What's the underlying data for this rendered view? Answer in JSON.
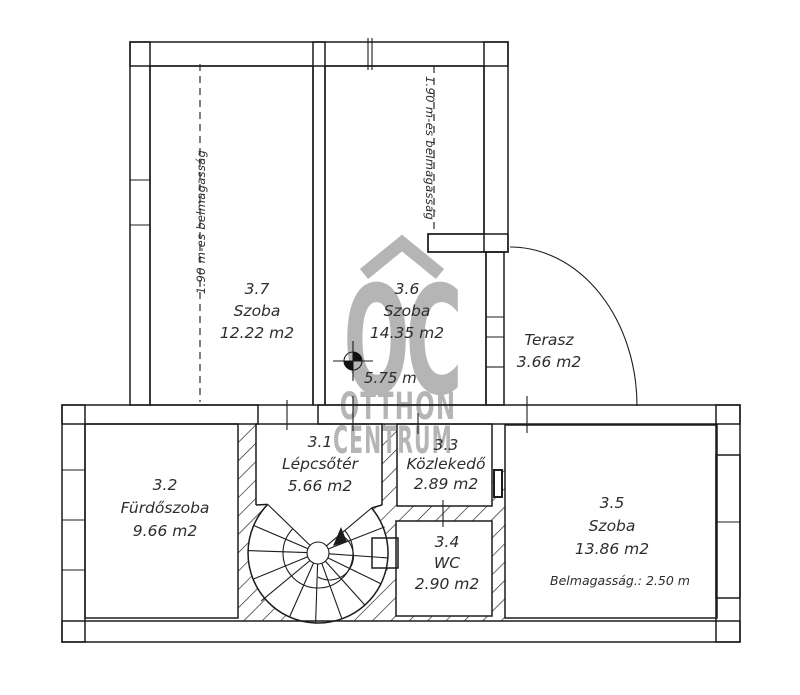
{
  "plan": {
    "rooms": {
      "r37": {
        "id": "3.7",
        "name": "Szoba",
        "area": "12.22 m2",
        "height_note": "1.90 m-es belmagasság"
      },
      "r36": {
        "id": "3.6",
        "name": "Szoba",
        "area": "14.35 m2",
        "height_note": "1.90 m-es belmagasság"
      },
      "terasz": {
        "name": "Terasz",
        "area": "3.66 m2"
      },
      "r31": {
        "id": "3.1",
        "name": "Lépcsőtér",
        "area": "5.66 m2"
      },
      "r32": {
        "id": "3.2",
        "name": "Fürdőszoba",
        "area": "9.66 m2"
      },
      "r33": {
        "id": "3.3",
        "name": "Közlekedő",
        "area": "2.89 m2"
      },
      "r34": {
        "id": "3.4",
        "name": "WC",
        "area": "2.90 m2"
      },
      "r35": {
        "id": "3.5",
        "name": "Szoba",
        "area": "13.86 m2",
        "ceiling_note": "Belmagasság.: 2.50 m"
      }
    },
    "level_mark": "5.75 m"
  },
  "watermark": {
    "letters": "OC",
    "line1": "OTTHON",
    "line2": "CENTRUM"
  },
  "colors": {
    "line": "#1c1c1c",
    "label": "#2d2d2d",
    "watermark": "#b5b5b5",
    "background": "#ffffff"
  }
}
